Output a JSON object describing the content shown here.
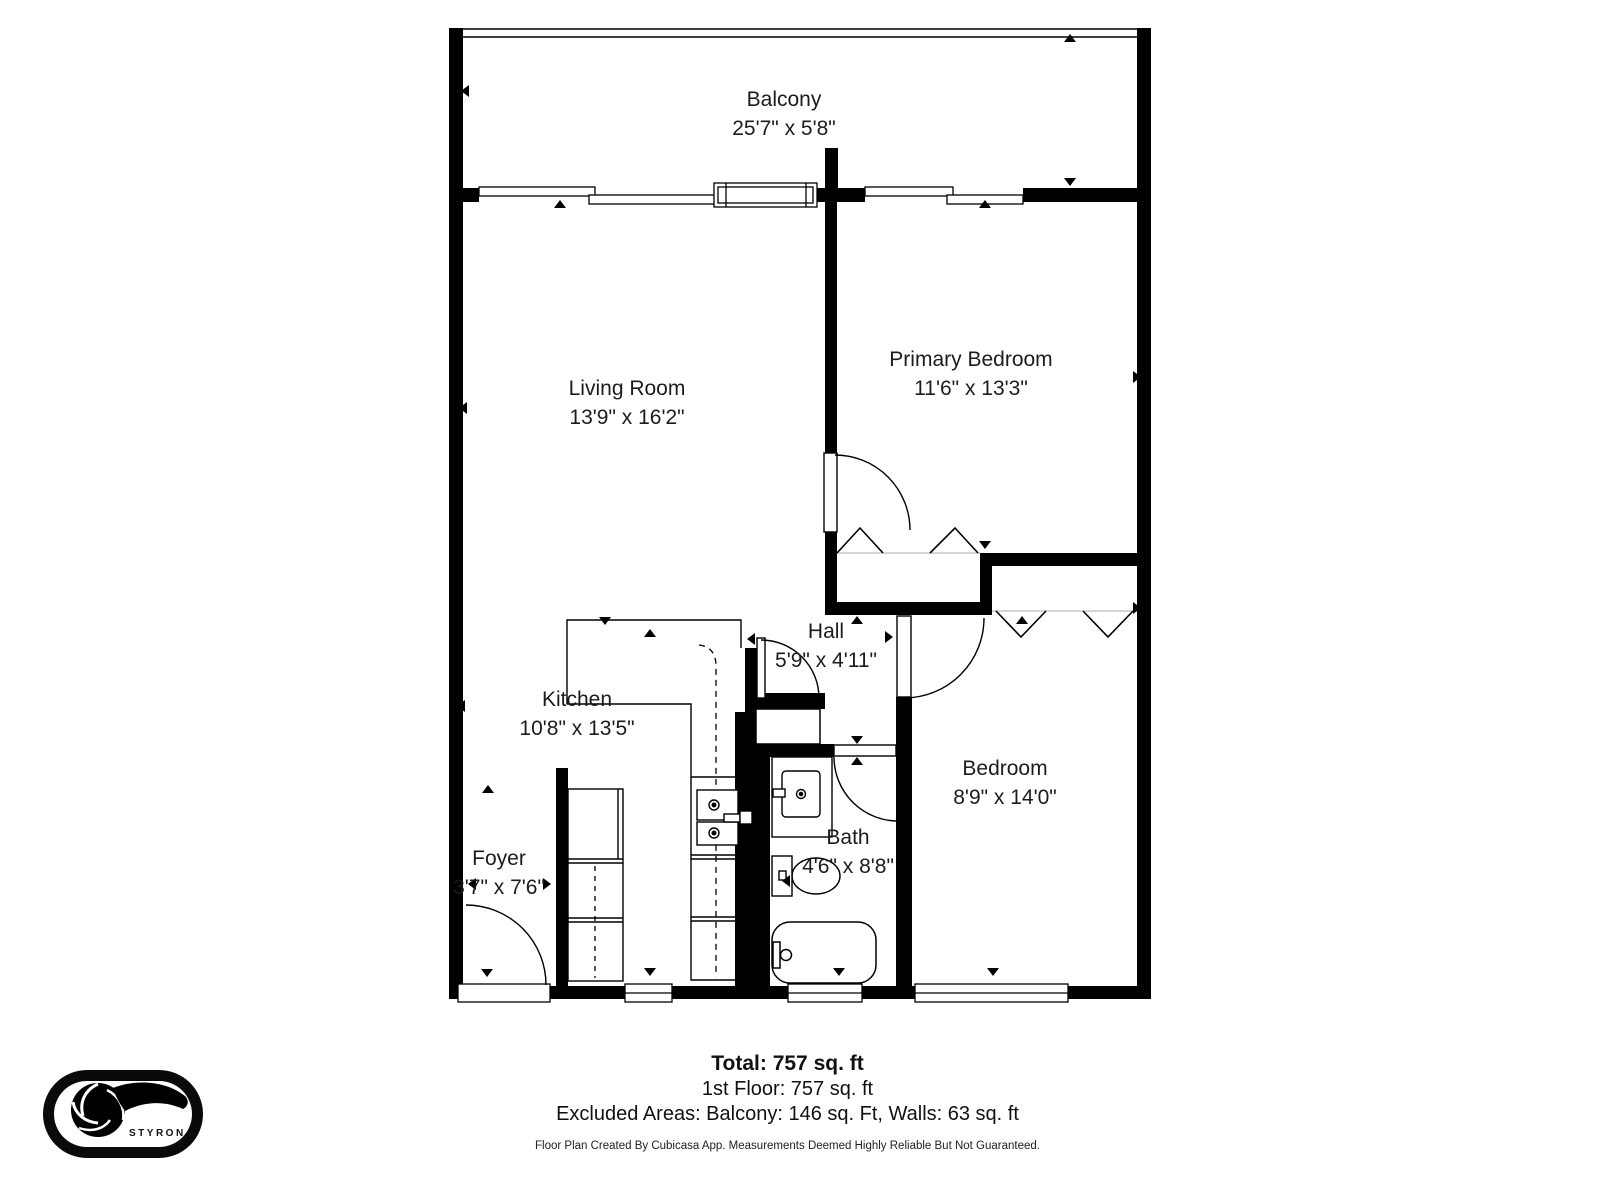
{
  "rooms": [
    {
      "id": "balcony",
      "name": "Balcony",
      "dims": "25'7\" x 5'8\""
    },
    {
      "id": "living-room",
      "name": "Living Room",
      "dims": "13'9\" x 16'2\""
    },
    {
      "id": "primary-bedroom",
      "name": "Primary Bedroom",
      "dims": "11'6\" x 13'3\""
    },
    {
      "id": "kitchen",
      "name": "Kitchen",
      "dims": "10'8\" x 13'5\""
    },
    {
      "id": "hall",
      "name": "Hall",
      "dims": "5'9\" x 4'11\""
    },
    {
      "id": "bedroom",
      "name": "Bedroom",
      "dims": "8'9\" x 14'0\""
    },
    {
      "id": "bath",
      "name": "Bath",
      "dims": "4'6\" x 8'8\""
    },
    {
      "id": "foyer",
      "name": "Foyer",
      "dims": "3'7\" x 7'6\""
    }
  ],
  "footer": {
    "total": "Total: 757 sq. ft",
    "first_floor": "1st Floor: 757 sq. ft",
    "excluded": "Excluded Areas: Balcony: 146 sq. Ft, Walls: 63 sq. ft",
    "disclaimer": "Floor Plan Created By Cubicasa App. Measurements Deemed Highly Reliable But Not Guaranteed."
  },
  "logo": {
    "text": "STYRON"
  },
  "colors": {
    "wall": "#000000",
    "background": "#ffffff",
    "label": "#1c1c1c"
  }
}
